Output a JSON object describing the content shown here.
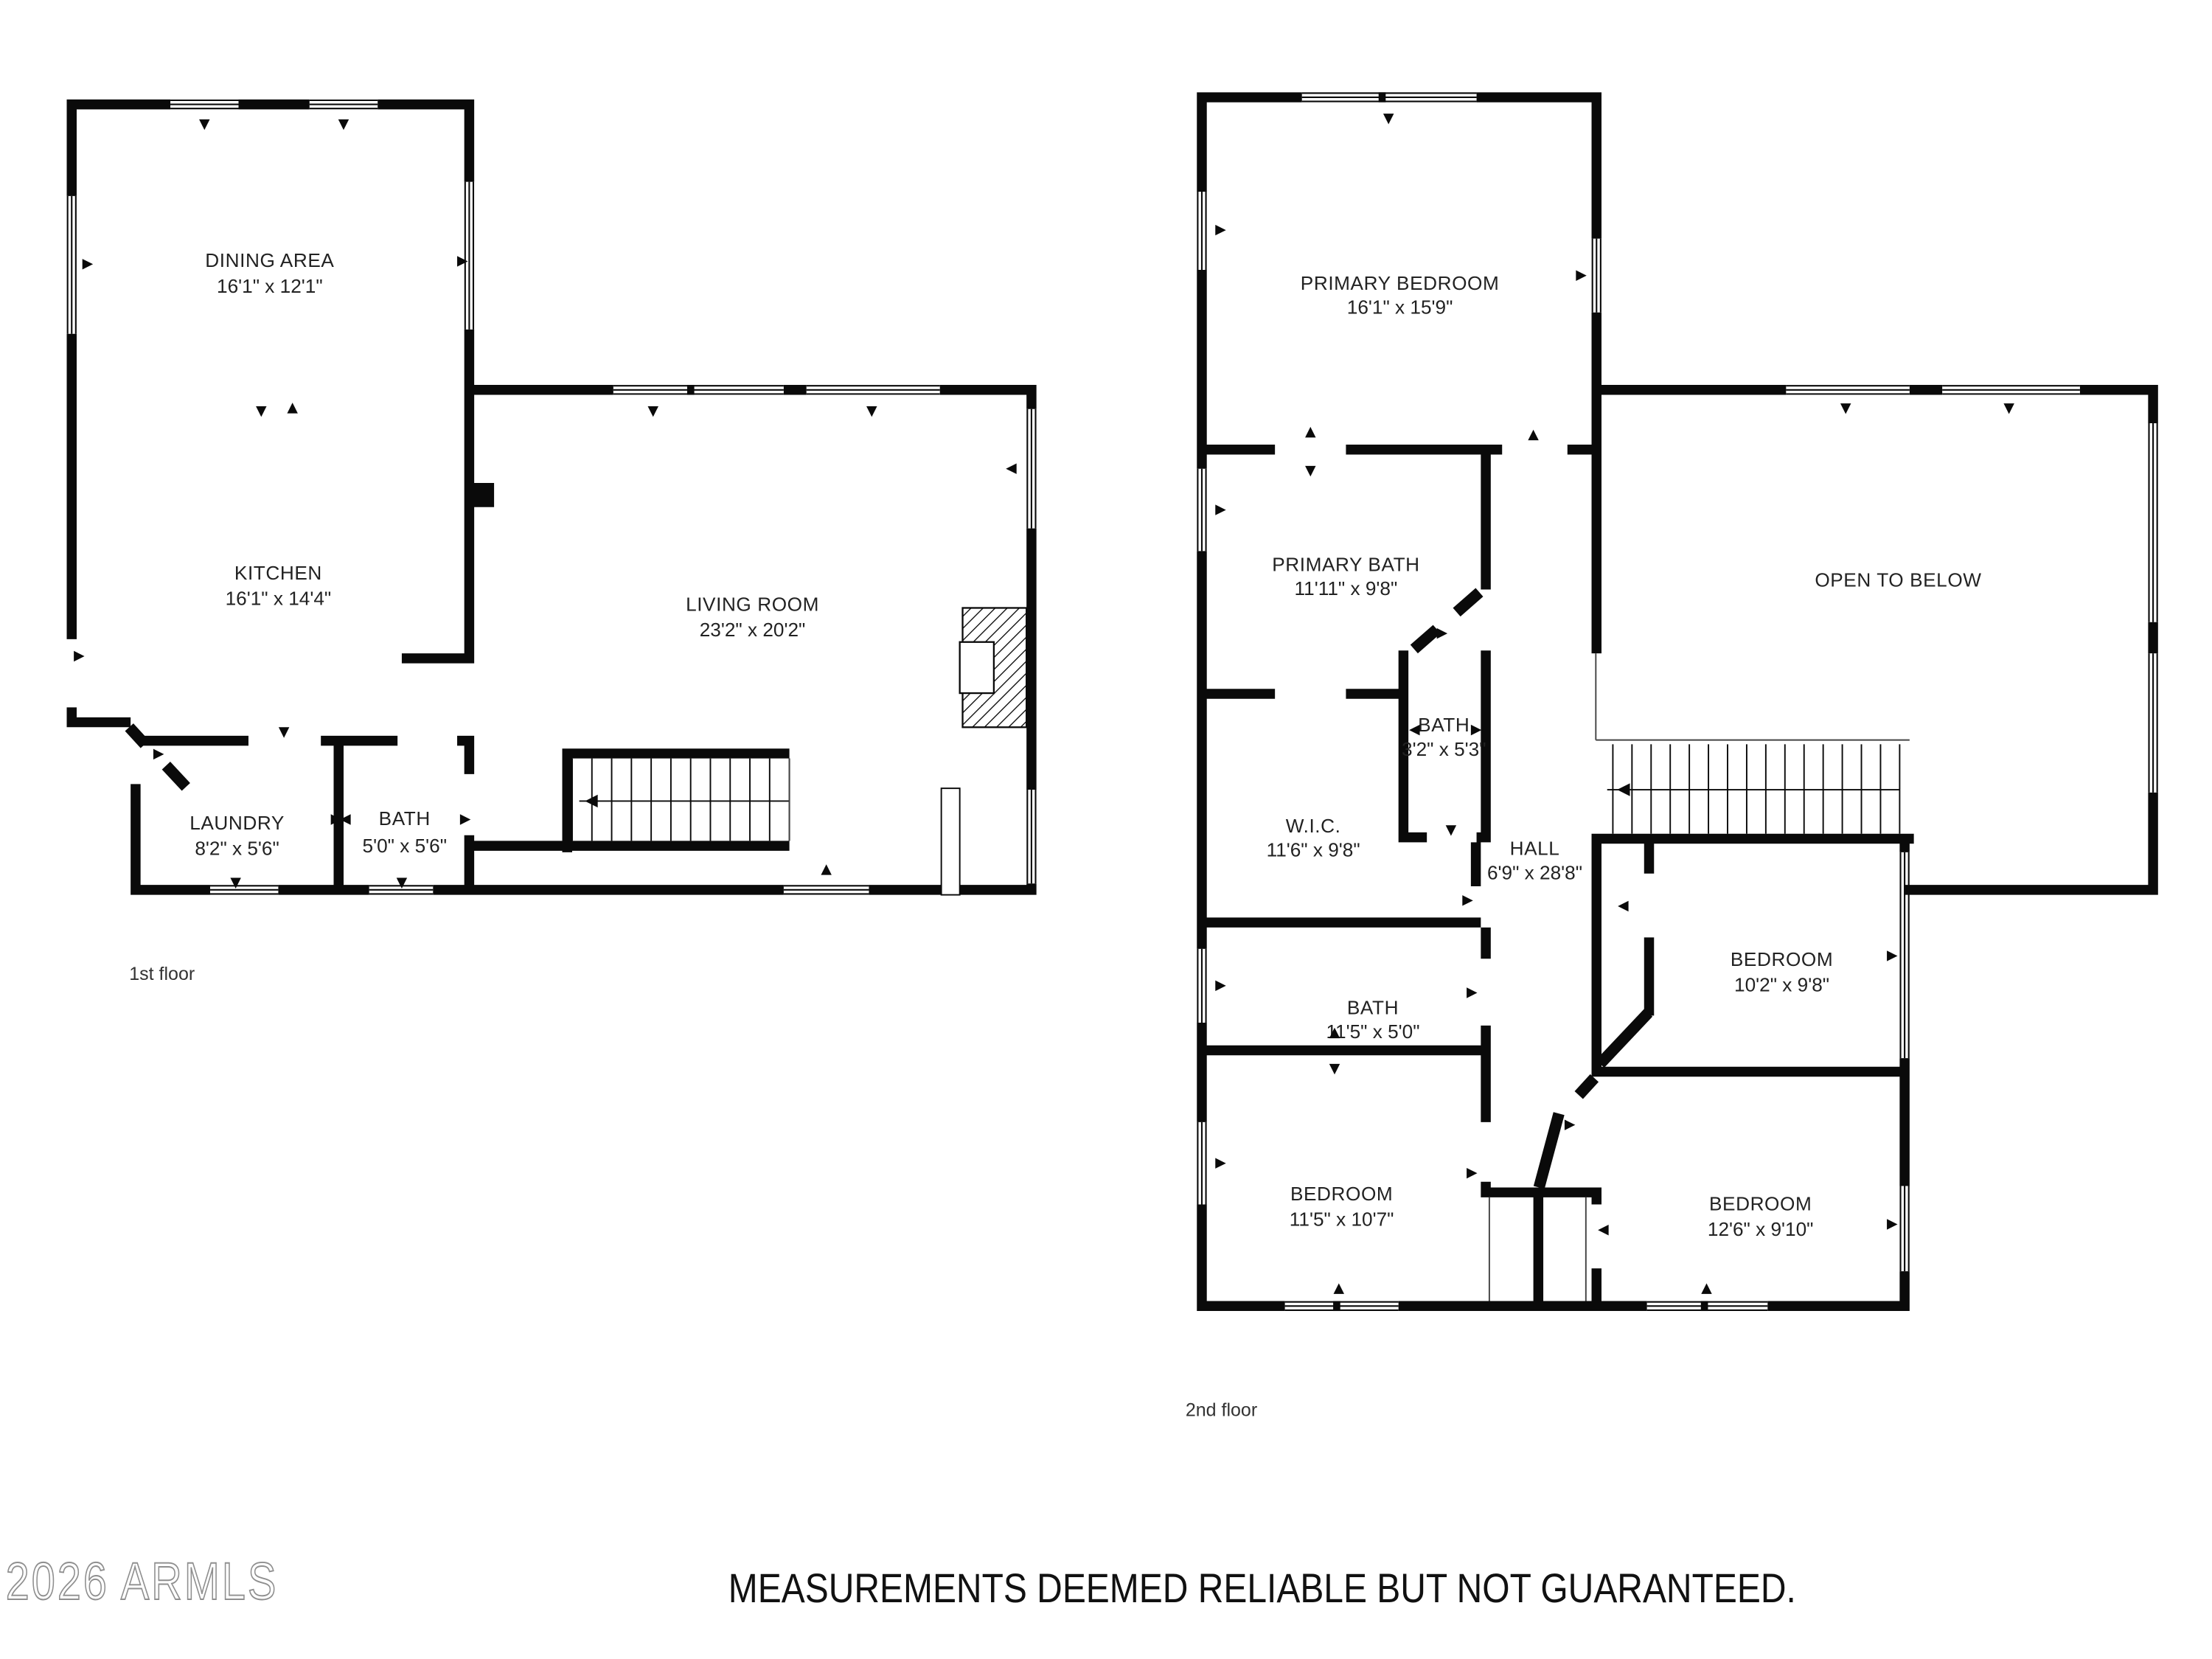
{
  "title": "Two-story residential floor plan",
  "colors": {
    "walls": "#0a0a0a",
    "label_text": "#222222",
    "watermark_gray": "#8f8f8f"
  },
  "floors": [
    {
      "caption": "1st floor",
      "rooms": [
        {
          "name": "DINING AREA",
          "dims": "16'1\" x 12'1\""
        },
        {
          "name": "KITCHEN",
          "dims": "16'1\" x 14'4\""
        },
        {
          "name": "LIVING ROOM",
          "dims": "23'2\" x 20'2\""
        },
        {
          "name": "LAUNDRY",
          "dims": "8'2\" x 5'6\""
        },
        {
          "name": "BATH",
          "dims": "5'0\" x 5'6\""
        }
      ]
    },
    {
      "caption": "2nd floor",
      "rooms": [
        {
          "name": "PRIMARY BEDROOM",
          "dims": "16'1\" x 15'9\""
        },
        {
          "name": "PRIMARY BATH",
          "dims": "11'11\" x 9'8\""
        },
        {
          "name": "BATH",
          "dims": "3'2\" x 5'3\""
        },
        {
          "name": "W.I.C.",
          "dims": "11'6\" x 9'8\""
        },
        {
          "name": "HALL",
          "dims": "6'9\" x 28'8\""
        },
        {
          "name": "OPEN TO BELOW",
          "dims": ""
        },
        {
          "name": "BEDROOM",
          "dims": "10'2\" x 9'8\""
        },
        {
          "name": "BATH",
          "dims": "11'5\" x 5'0\""
        },
        {
          "name": "BEDROOM",
          "dims": "11'5\" x 10'7\""
        },
        {
          "name": "BEDROOM",
          "dims": "12'6\" x 9'10\""
        }
      ]
    }
  ],
  "footer": {
    "watermark": "2026 ARMLS",
    "disclaimer": "MEASUREMENTS DEEMED RELIABLE BUT NOT GUARANTEED."
  }
}
